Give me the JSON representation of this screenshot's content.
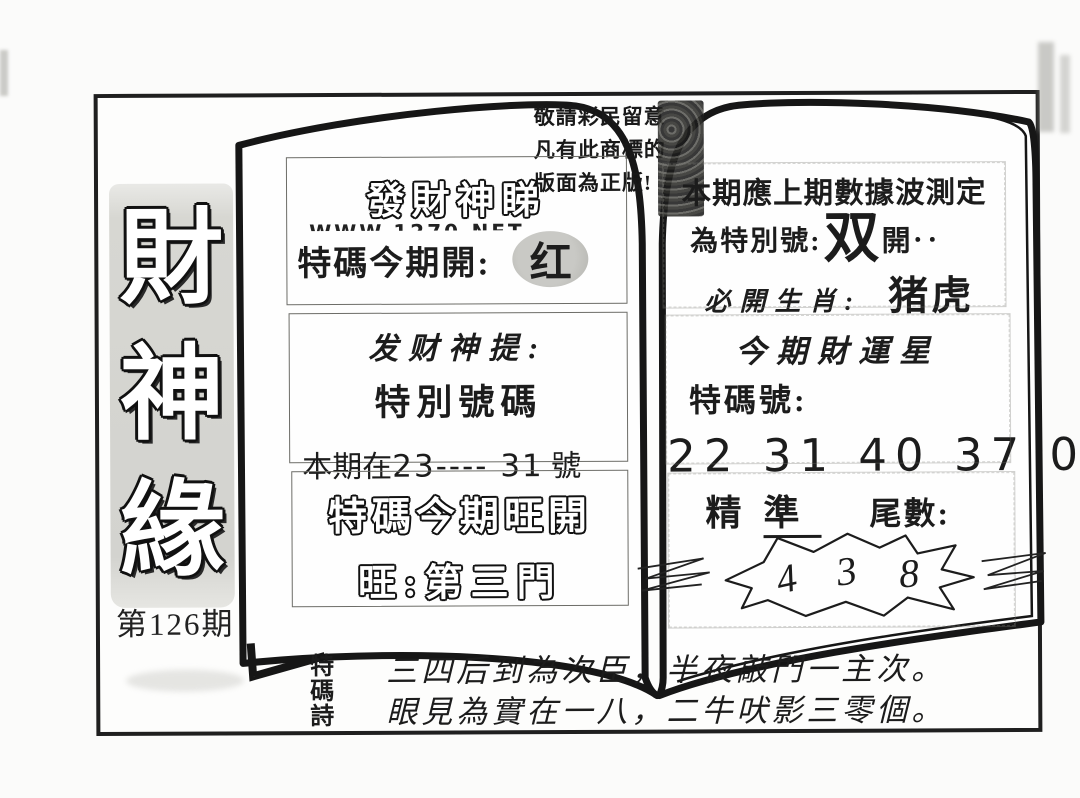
{
  "issue": {
    "label": "第126期"
  },
  "banner": {
    "chars": [
      "財",
      "神",
      "緣"
    ]
  },
  "notice": {
    "lines": [
      "敬請彩民留意",
      "凡有此商標的",
      "版面為正版!"
    ]
  },
  "left_page": {
    "box1": {
      "title": "發財神睇",
      "watermark": "WWW.1270.NET",
      "open_label": "特碼今期開:",
      "open_value": "红"
    },
    "box2": {
      "line1": "发财神提:",
      "line2": "特別號碼",
      "line3_prefix": "本期在",
      "line3_range": "23---- 31",
      "line3_suffix": "號"
    },
    "box3": {
      "line1": "特碼今期旺開",
      "line2": "旺:第三門"
    }
  },
  "right_page": {
    "box1": {
      "line1": "本期應上期數據波測定",
      "line2_label": "為特別號:",
      "line2_value": "双",
      "line2_suffix": "開‥",
      "line3_label": "必開生肖:",
      "line3_value": "猪虎"
    },
    "box2": {
      "line1": "今期財運星",
      "line2": "特碼號:",
      "numbers": "22 31 40 37 08 37"
    },
    "box3": {
      "label_jing": "精",
      "label_zhun": "準",
      "label_tail": "尾數:",
      "digits": [
        "4",
        "3",
        "8"
      ]
    }
  },
  "poem": {
    "label_chars": [
      "特",
      "碼",
      "詩"
    ],
    "line1": "三四后到為次臣，半夜敲門一主次。",
    "line2": "眼見為實在一八，二牛吠影三零個。"
  },
  "colors": {
    "ink": "#1c1c1c",
    "banner_gray": "#d5d5d1",
    "blob_gray": "#bdbdb8"
  }
}
